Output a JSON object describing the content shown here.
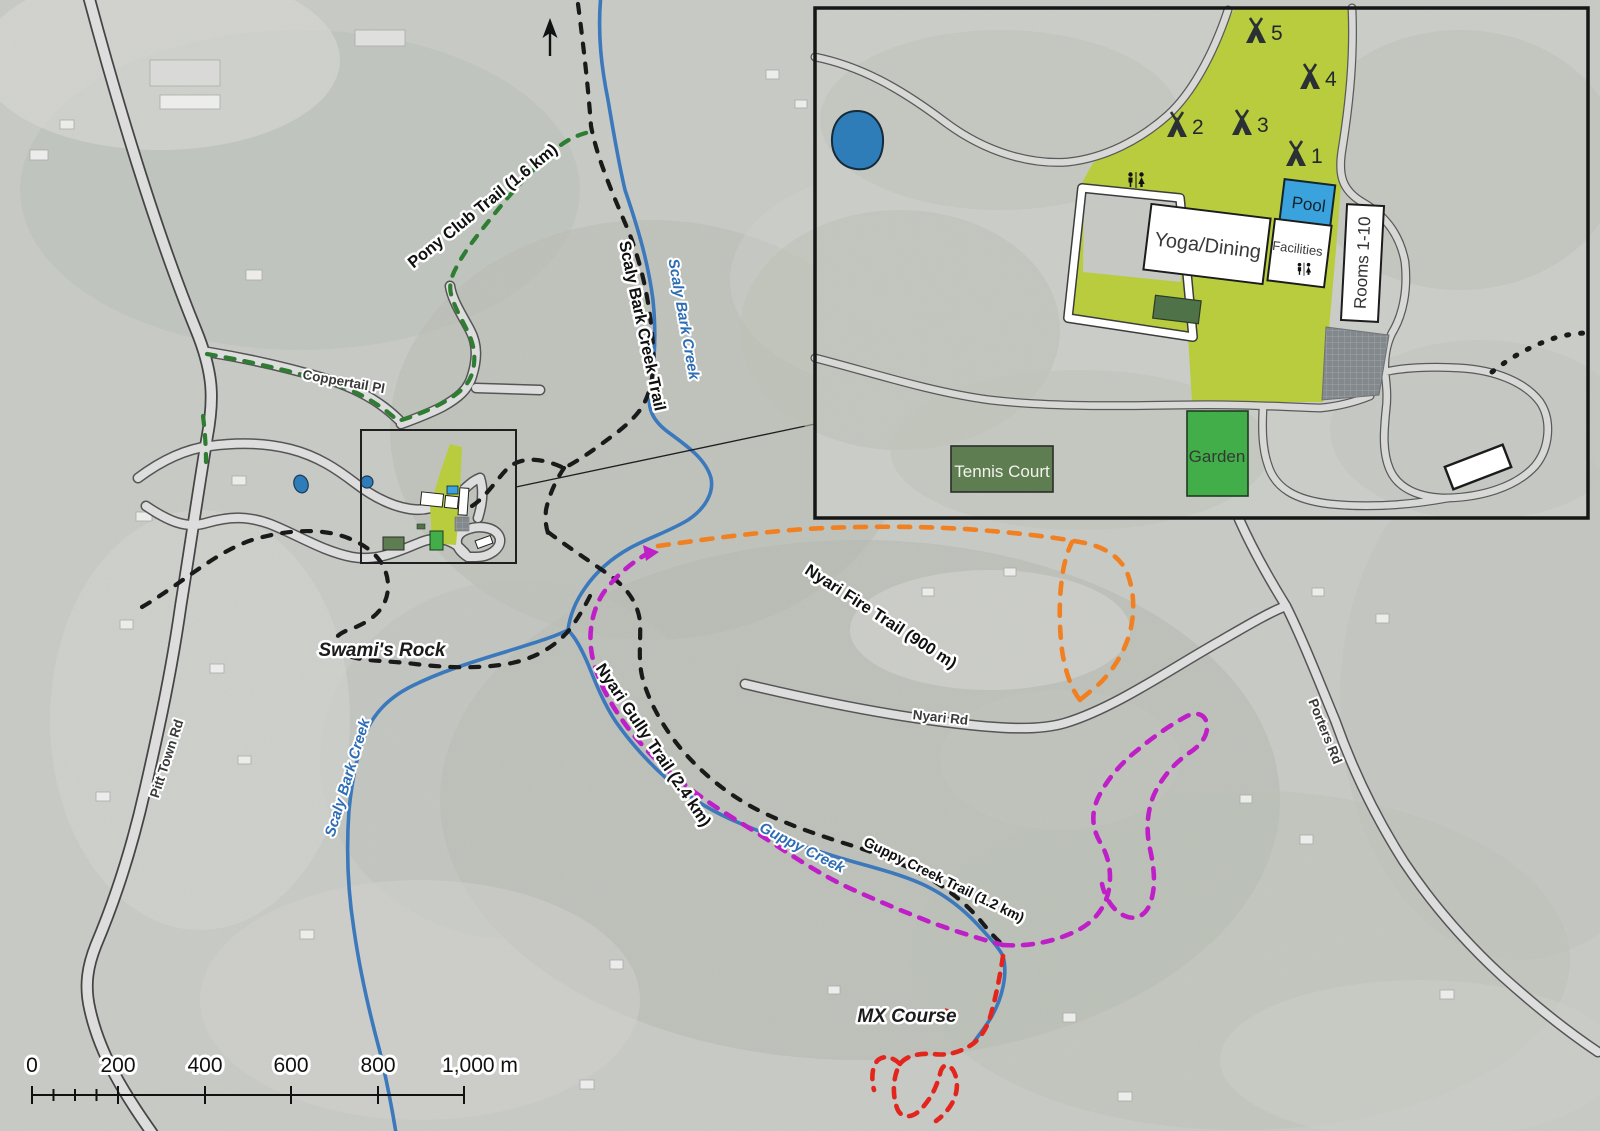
{
  "main_map": {
    "roads": {
      "pitt_town_rd": "Pitt Town Rd",
      "coppertail_pl": "Coppertail Pl",
      "nyari_rd": "Nyari Rd",
      "porters_rd": "Porters Rd"
    },
    "waterways": {
      "scaly_bark_creek": "Scaly Bark Creek",
      "guppy_creek": "Guppy Creek"
    },
    "trails": {
      "pony_club": "Pony Club Trail (1.6 km)",
      "scaly_bark": "Scaly Bark Creek Trail",
      "nyari_fire": "Nyari Fire Trail (900 m)",
      "nyari_gully": "Nyari Gully Trail (2.4 km)",
      "guppy_creek": "Guppy Creek Trail (1.2 km)"
    },
    "landmarks": {
      "swamis_rock": "Swami's Rock",
      "mx_course": "MX Course"
    },
    "scale_bar": {
      "labels": [
        "0",
        "200",
        "400",
        "600",
        "800",
        "1,000 m"
      ]
    }
  },
  "inset": {
    "campsites": [
      "1",
      "2",
      "3",
      "4",
      "5"
    ],
    "facilities": {
      "yoga_dining": "Yoga/Dining",
      "facilities": "Facilities",
      "rooms": "Rooms 1-10",
      "pool": "Pool",
      "garden": "Garden",
      "tennis_court": "Tennis Court"
    }
  },
  "colors": {
    "trail_black": "#1a1a1a",
    "trail_green": "#2e7d32",
    "trail_orange": "#f08021",
    "trail_magenta": "#bf1fc7",
    "trail_red": "#e3261d",
    "creek_blue": "#3b78bc",
    "camp_green": "#b8cc3e",
    "garden_green": "#42ae49",
    "tennis_green": "#5e7d50",
    "pool_blue": "#3aa2dc",
    "pond_blue": "#2e7cb8",
    "road_fill": "#dcdddc",
    "road_casing": "#4f4f4f"
  }
}
